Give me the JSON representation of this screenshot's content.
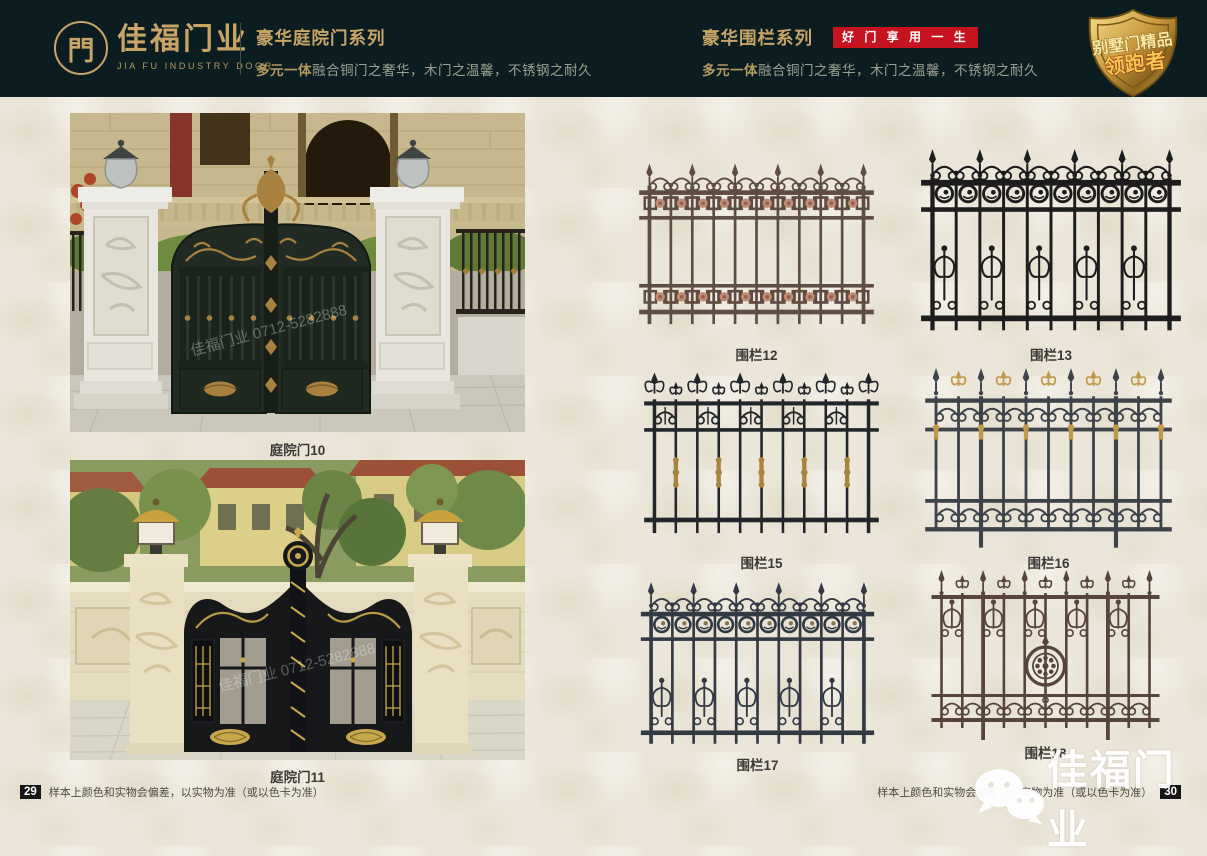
{
  "header": {
    "logo_symbol": "門",
    "brand": "佳福门业",
    "brand_en": "JIA FU INDUSTRY DOOR",
    "left": {
      "title": "豪华庭院门系列",
      "subtitle_lead": "多元一体",
      "subtitle_rest": "融合铜门之奢华，木门之温馨，不锈钢之耐久"
    },
    "right": {
      "title": "豪华围栏系列",
      "badge": "好 门 享 用 一 生",
      "subtitle_lead": "多元一体",
      "subtitle_rest": "融合铜门之奢华，木门之温馨，不锈钢之耐久"
    },
    "shield": {
      "line1": "别墅门精品",
      "line2": "领跑者"
    },
    "colors": {
      "bg": "#0c1d21",
      "gold": "#c8a566",
      "badge_red": "#c61320"
    }
  },
  "left_page": {
    "photos": [
      {
        "caption": "庭院门10"
      },
      {
        "caption": "庭院门11"
      }
    ],
    "photo_watermark": "佳福门业 0712-5282888",
    "footer": {
      "page_number": "29",
      "disclaimer": "样本上颜色和实物会偏差，以实物为准（或以色卡为准）"
    }
  },
  "right_page": {
    "fences": [
      {
        "caption": "围栏12",
        "style": "rosette-band",
        "color": "#5f4c42",
        "accent": "#c08b74"
      },
      {
        "caption": "围栏13",
        "style": "circle-scroll",
        "color": "#1d1d1d",
        "accent": "#1d1d1d"
      },
      {
        "caption": "围栏15",
        "style": "fleur-collar",
        "color": "#22262a",
        "accent": "#a8853f"
      },
      {
        "caption": "围栏16",
        "style": "double-scroll",
        "color": "#3d4349",
        "accent": "#c09a4c"
      },
      {
        "caption": "围栏17",
        "style": "crest-circle-scroll",
        "color": "#333a43",
        "accent": "#8a7454"
      },
      {
        "caption": "围栏18",
        "style": "medallion",
        "color": "#57453c",
        "accent": "#57453c"
      }
    ],
    "footer": {
      "page_number": "30",
      "disclaimer": "样本上颜色和实物会偏差，以实物为准（或以色卡为准）"
    }
  },
  "watermark": {
    "text": "佳福门业"
  }
}
